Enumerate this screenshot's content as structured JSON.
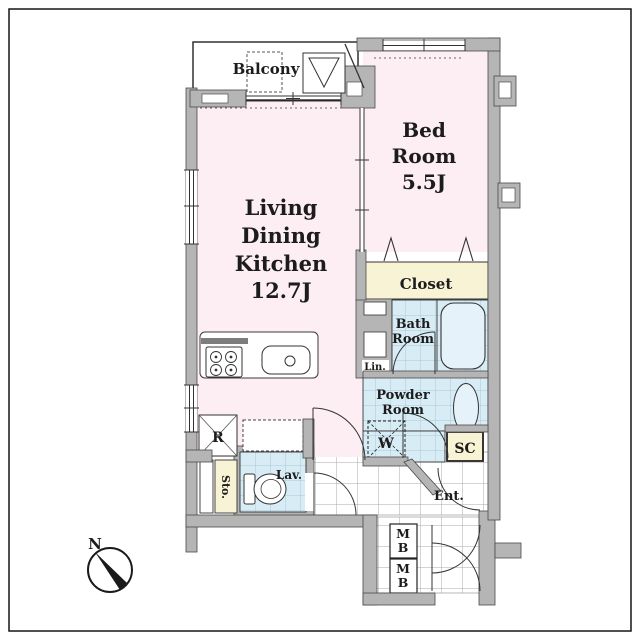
{
  "floor_plan": {
    "rooms": {
      "balcony": {
        "label": "Balcony"
      },
      "bedroom": {
        "line1": "Bed",
        "line2": "Room",
        "size": "5.5J"
      },
      "living_dining_kitchen": {
        "line1": "Living",
        "line2": "Dining",
        "line3": "Kitchen",
        "size": "12.7J"
      },
      "closet": {
        "label": "Closet"
      },
      "bathroom": {
        "line1": "Bath",
        "line2": "Room"
      },
      "powder_room": {
        "line1": "Powder",
        "line2": "Room"
      },
      "lavatory": {
        "label": "Lav."
      },
      "entrance": {
        "label": "Ent."
      }
    },
    "fixtures": {
      "linen": {
        "label": "Lin."
      },
      "storage": {
        "label": "Sto."
      },
      "washer": {
        "label": "W"
      },
      "refrigerator": {
        "label": "R"
      },
      "shoe_closet": {
        "label": "SC"
      },
      "meter_box_1": {
        "line1": "M",
        "line2": "B"
      },
      "meter_box_2": {
        "line1": "M",
        "line2": "B"
      }
    },
    "compass": {
      "north_label": "N"
    },
    "colors": {
      "wall_gray": "#b5b5b5",
      "room_pink": "#fdeef3",
      "closet_cream": "#f9f3d6",
      "wet_area_blue": "#d8ecf5",
      "line_dark": "#2b2b2b"
    }
  }
}
